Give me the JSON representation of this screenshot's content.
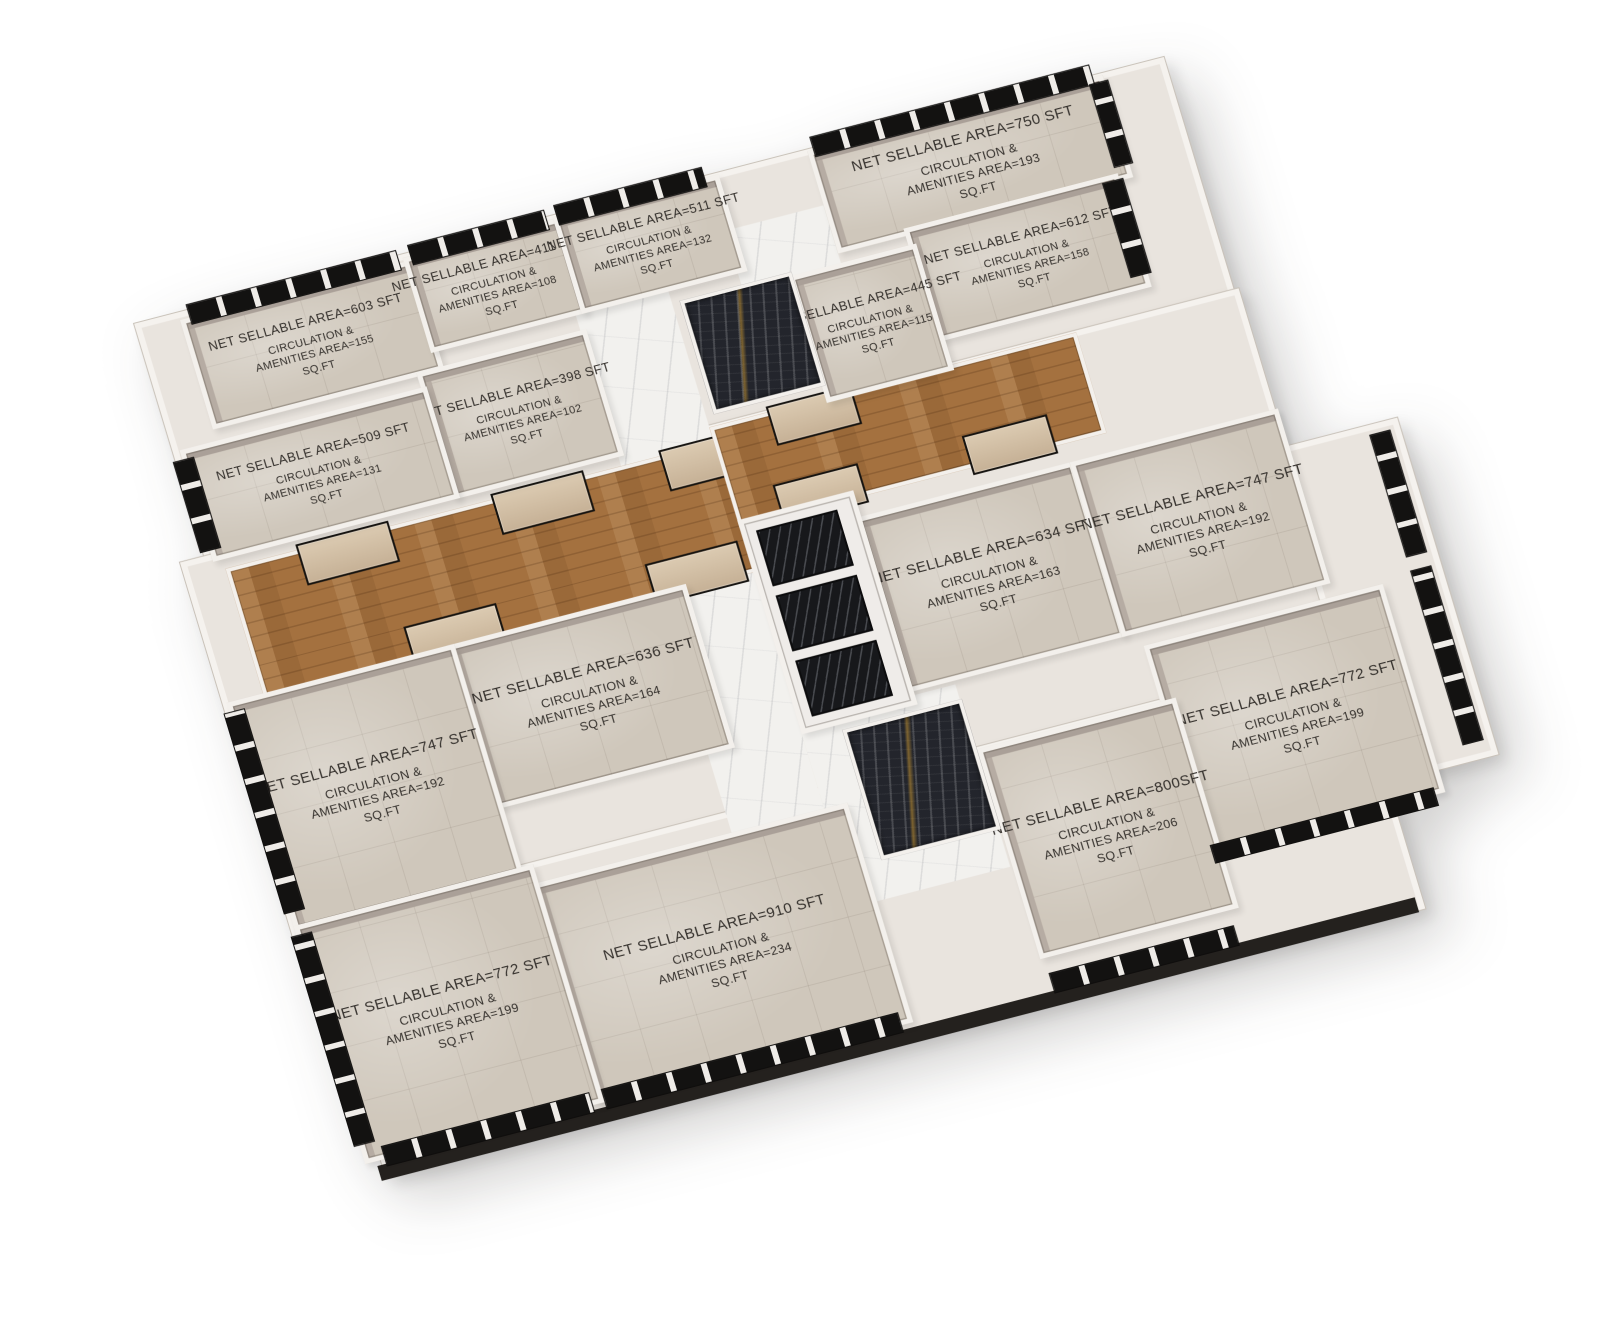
{
  "units": [
    {
      "id": "unit-603",
      "net": "NET SELLABLE AREA=603 SFT",
      "amenities": "CIRCULATION &\nAMENITIES AREA=155\nSQ.FT"
    },
    {
      "id": "unit-411",
      "net": "NET SELLABLE AREA=411 SFT",
      "amenities": "CIRCULATION &\nAMENITIES AREA=108\nSQ.FT"
    },
    {
      "id": "unit-511",
      "net": "NET SELLABLE AREA=511 SFT",
      "amenities": "CIRCULATION &\nAMENITIES AREA=132\nSQ.FT"
    },
    {
      "id": "unit-398",
      "net": "NET SELLABLE AREA=398 SFT",
      "amenities": "CIRCULATION &\nAMENITIES AREA=102\nSQ.FT"
    },
    {
      "id": "unit-509",
      "net": "NET SELLABLE AREA=509 SFT",
      "amenities": "CIRCULATION &\nAMENITIES AREA=131\nSQ.FT"
    },
    {
      "id": "unit-750",
      "net": "NET SELLABLE AREA=750 SFT",
      "amenities": "CIRCULATION &\nAMENITIES AREA=193\nSQ.FT"
    },
    {
      "id": "unit-612",
      "net": "NET SELLABLE AREA=612 SFT",
      "amenities": "CIRCULATION &\nAMENITIES AREA=158\nSQ.FT"
    },
    {
      "id": "unit-445",
      "net": "NET SELLABLE AREA=445 SFT",
      "amenities": "CIRCULATION &\nAMENITIES AREA=115\nSQ.FT"
    },
    {
      "id": "unit-634",
      "net": "NET SELLABLE AREA=634 SFT",
      "amenities": "CIRCULATION &\nAMENITIES AREA=163\nSQ.FT"
    },
    {
      "id": "unit-747-right",
      "net": "NET SELLABLE AREA=747 SFT",
      "amenities": "CIRCULATION &\nAMENITIES AREA=192\nSQ.FT"
    },
    {
      "id": "unit-772-right",
      "net": "NET SELLABLE AREA=772 SFT",
      "amenities": "CIRCULATION &\nAMENITIES AREA=199\nSQ.FT"
    },
    {
      "id": "unit-800",
      "net": "NET SELLABLE AREA=800SFT",
      "amenities": "CIRCULATION &\nAMENITIES AREA=206\nSQ.FT"
    },
    {
      "id": "unit-910",
      "net": "NET SELLABLE AREA=910 SFT",
      "amenities": "CIRCULATION &\nAMENITIES AREA=234\nSQ.FT"
    },
    {
      "id": "unit-636",
      "net": "NET SELLABLE AREA=636 SFT",
      "amenities": "CIRCULATION &\nAMENITIES AREA=164\nSQ.FT"
    },
    {
      "id": "unit-747-left",
      "net": "NET SELLABLE AREA=747 SFT",
      "amenities": "CIRCULATION &\nAMENITIES AREA=192\nSQ.FT"
    },
    {
      "id": "unit-772-left",
      "net": "NET SELLABLE AREA=772 SFT",
      "amenities": "CIRCULATION &\nAMENITIES AREA=199\nSQ.FT"
    }
  ],
  "colors": {
    "background": "#ffffff",
    "wall": "#f3f0ec",
    "wall_face": "#a89b93",
    "floor_tile": "#cfc7bb",
    "floor_wood": "#a4713f",
    "corridor_marble": "#f2f1ee",
    "stair_marble_dark": "#23252c",
    "stair_marble_gold": "#d6a032",
    "window_frame": "#131211",
    "plinth": "#24211e",
    "label_text": "#35312d"
  }
}
